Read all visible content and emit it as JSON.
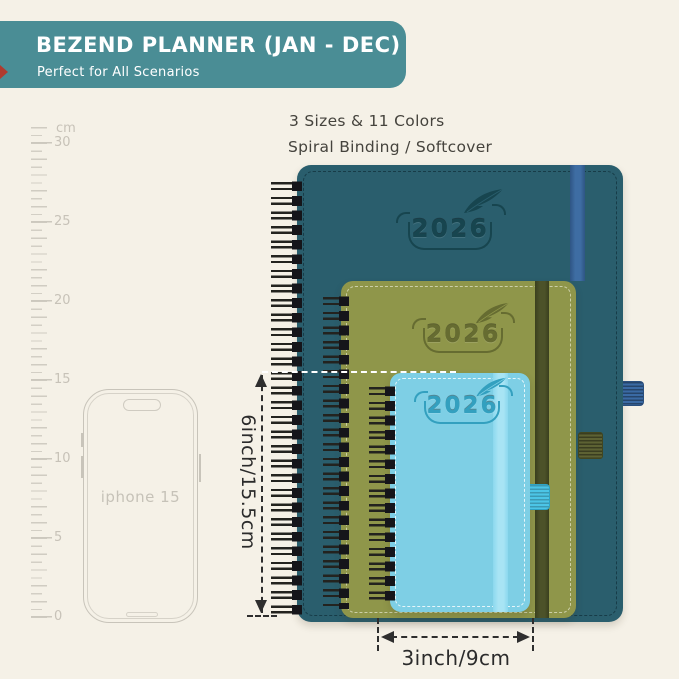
{
  "header": {
    "title": "BEZEND PLANNER (JAN - DEC)",
    "subtitle": "Perfect for All Scenarios",
    "colors": {
      "background": "#4a8d95",
      "text": "#ffffff",
      "accent_mark": "#b03a2e"
    }
  },
  "tagline": {
    "line1": "3 Sizes & 11 Colors",
    "line2": "Spiral Binding / Softcover"
  },
  "ruler": {
    "unit_label": "cm",
    "tick_labels": [
      "30",
      "25",
      "20",
      "15",
      "10",
      "5",
      "0"
    ]
  },
  "phone": {
    "label": "iphone 15"
  },
  "planners": {
    "large": {
      "year": "2026",
      "cover_color": "#2a5e6d",
      "elastic_color": "#3e6da3",
      "pen_loop_color": "#3a6aa4"
    },
    "medium": {
      "year": "2026",
      "cover_color": "#8f964a",
      "elastic_color": "#4c5229",
      "pen_loop_color": "#5d6233"
    },
    "small": {
      "year": "2026",
      "cover_color": "#7ecfe5",
      "elastic_color": "#a8e4f4",
      "pen_loop_color": "#4cc5e6"
    }
  },
  "dimensions": {
    "height_label": "6inch/15.5cm",
    "width_label": "3inch/9cm"
  },
  "background_color": "#f5f1e7"
}
